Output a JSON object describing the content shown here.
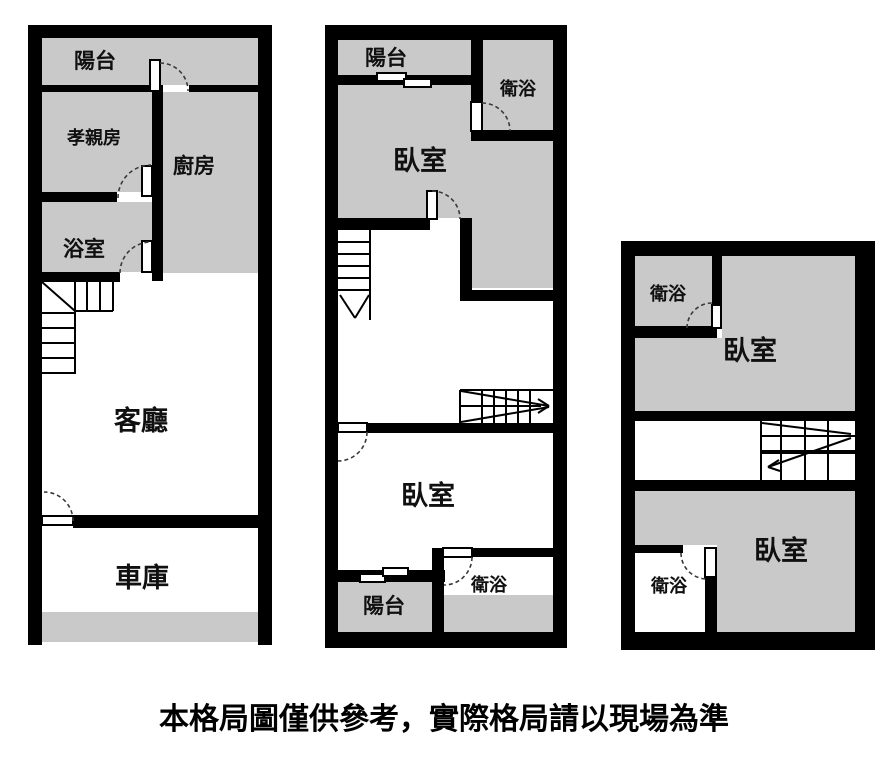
{
  "caption": "本格局圖僅供參考，實際格局請以現場為準",
  "colors": {
    "wall": "#000000",
    "room_fill": "#c9c9c9",
    "background": "#ffffff"
  },
  "plans": {
    "f1": {
      "balcony": "陽台",
      "parents_room": "孝親房",
      "kitchen": "廚房",
      "bathroom": "浴室",
      "living_room": "客廳",
      "garage": "車庫"
    },
    "f2": {
      "balcony_front": "陽台",
      "bathroom_front": "衛浴",
      "bedroom_front": "臥室",
      "bedroom_rear": "臥室",
      "balcony_rear": "陽台",
      "bathroom_rear": "衛浴"
    },
    "f3": {
      "bathroom_front": "衛浴",
      "bedroom_front": "臥室",
      "bathroom_rear": "衛浴",
      "bedroom_rear": "臥室"
    }
  }
}
